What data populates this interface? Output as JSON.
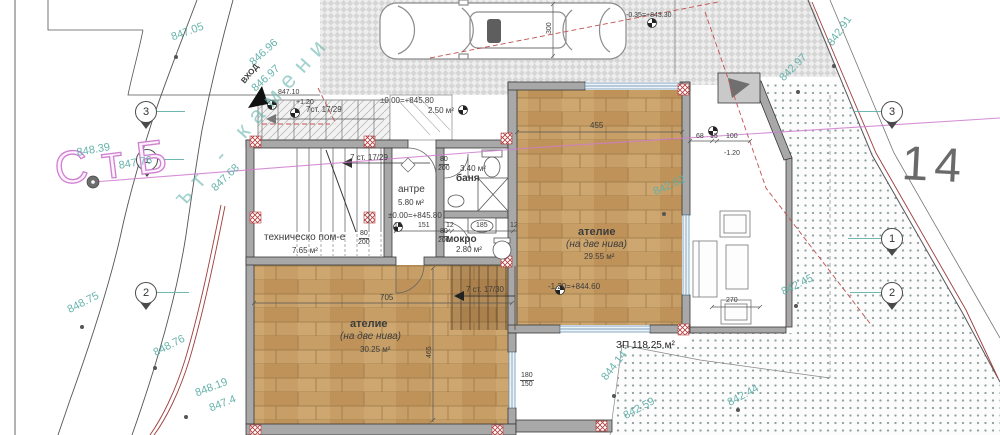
{
  "site": {
    "street_label": "СтБ",
    "road_label": "ът - камени",
    "parcel_number": "14",
    "entrance_label": "ВХОД",
    "built_area_label": "ЗП 118.25 м²",
    "parking_level": "-0.35=+843.30",
    "spot_elevations": {
      "a": "847.05",
      "b": "846.96",
      "c": "846.97",
      "d": "848.39",
      "e": "847.76",
      "f": "847.68",
      "g": "848.75",
      "h": "848.76",
      "i": "848.19",
      "j": "847.4",
      "k": "842.91",
      "l": "842.97",
      "m": "842.62",
      "n": "842.45",
      "o": "844.14",
      "p": "842.59",
      "q": "842.44"
    },
    "boundary_markers": {
      "m1": "1",
      "m2": "2",
      "m3": "3"
    }
  },
  "building": {
    "rooms": {
      "tech": {
        "name": "техническо пом-е",
        "area": "7.65 м²"
      },
      "antre": {
        "name": "антре",
        "area": "5.80 м²",
        "level": "±0.00=+845.80"
      },
      "banya": {
        "name": "баня",
        "area": "3.40 м²"
      },
      "mokro": {
        "name": "мокро",
        "area": "2.80 м²"
      },
      "atelier_right": {
        "name": "ателие",
        "sub": "(на две нива)",
        "area": "29.55 м²",
        "level": "-1.20=+844.60"
      },
      "atelier_lower": {
        "name": "ателие",
        "sub": "(на две нива)",
        "area": "30.25 м²"
      }
    },
    "porch": {
      "level": "±0.00=+845.80",
      "area": "2.50 м²",
      "top_elev": "847.10",
      "delta": "+1.20"
    },
    "stairs": {
      "exterior": "7ст. 17/29",
      "main": "7 ст. 17/29",
      "lower": "7 ст. 17/30"
    }
  },
  "dimensions": {
    "d455": "455",
    "d68": "68",
    "d15": "15",
    "d100": "100",
    "dneg120": "-1.20",
    "d705": "705",
    "d465": "465",
    "d12": "12",
    "d151": "151",
    "d185": "185",
    "d270": "270",
    "d300": "300",
    "door_w": "80",
    "door_h": "200",
    "win_w": "180",
    "win_h": "150"
  }
}
